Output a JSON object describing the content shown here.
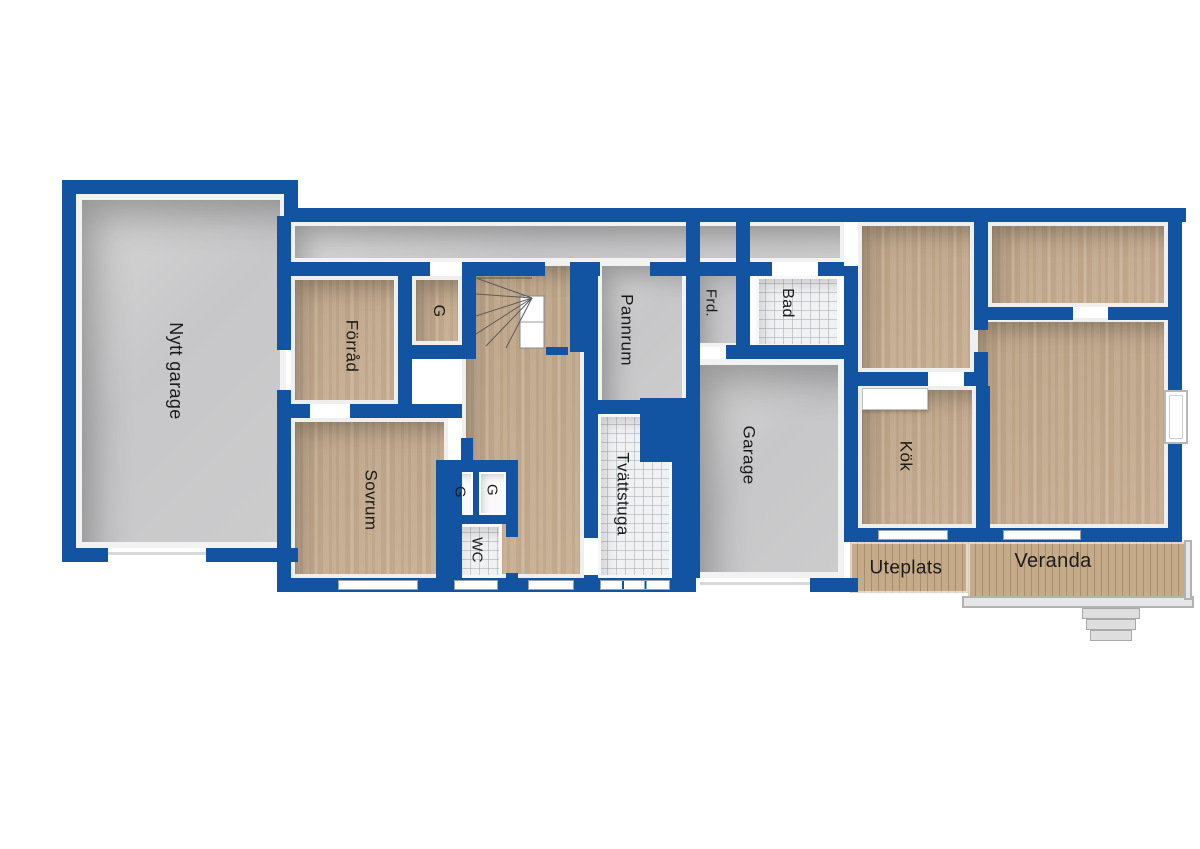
{
  "plan": {
    "title": "Floor plan",
    "width_px": 1200,
    "height_px": 849,
    "style": "Swedish real-estate floor plan, pseudo-3D blue walls"
  },
  "colors": {
    "wall_blue": "#1254a2",
    "wood_floor": "#c9b093",
    "concrete_gray": "#c8c8ca",
    "tile": "#f0f1f3",
    "deck_wood": "#c6ab8a",
    "label_text": "#1b1b1b"
  },
  "rooms": [
    "Nytt garage",
    "Förråd",
    "G",
    "Sovrum",
    "G",
    "G",
    "WC",
    "Pannrum",
    "Tvättstuga",
    "Frd.",
    "Bad",
    "Garage",
    "Kök",
    "Uteplats",
    "Veranda"
  ],
  "labels": [
    {
      "id": "nytt-garage",
      "text": "Nytt garage",
      "x": 176,
      "y": 371,
      "rot": 90,
      "size": 18
    },
    {
      "id": "forrad",
      "text": "Förråd",
      "x": 352,
      "y": 346,
      "rot": 90,
      "size": 17
    },
    {
      "id": "g-hall",
      "text": "G",
      "x": 438,
      "y": 311,
      "rot": 90,
      "size": 16
    },
    {
      "id": "sovrum",
      "text": "Sovrum",
      "x": 371,
      "y": 500,
      "rot": 90,
      "size": 17
    },
    {
      "id": "g-closet-left",
      "text": "G",
      "x": 460,
      "y": 492,
      "rot": 90,
      "size": 15
    },
    {
      "id": "g-closet-right",
      "text": "G",
      "x": 492,
      "y": 490,
      "rot": 90,
      "size": 15
    },
    {
      "id": "wc",
      "text": "WC",
      "x": 477,
      "y": 550,
      "rot": 90,
      "size": 15
    },
    {
      "id": "pannrum",
      "text": "Pannrum",
      "x": 627,
      "y": 330,
      "rot": 90,
      "size": 17
    },
    {
      "id": "tvattstuga",
      "text": "Tvättstuga",
      "x": 623,
      "y": 494,
      "rot": 90,
      "size": 17
    },
    {
      "id": "frd",
      "text": "Frd.",
      "x": 711,
      "y": 303,
      "rot": 90,
      "size": 15
    },
    {
      "id": "bad",
      "text": "Bad",
      "x": 787,
      "y": 303,
      "rot": 90,
      "size": 16
    },
    {
      "id": "garage",
      "text": "Garage",
      "x": 749,
      "y": 455,
      "rot": 90,
      "size": 17
    },
    {
      "id": "kok",
      "text": "Kök",
      "x": 906,
      "y": 456,
      "rot": 90,
      "size": 17
    },
    {
      "id": "uteplats",
      "text": "Uteplats",
      "x": 906,
      "y": 568,
      "rot": 0,
      "size": 19
    },
    {
      "id": "veranda",
      "text": "Veranda",
      "x": 1053,
      "y": 561,
      "rot": 0,
      "size": 20
    }
  ]
}
